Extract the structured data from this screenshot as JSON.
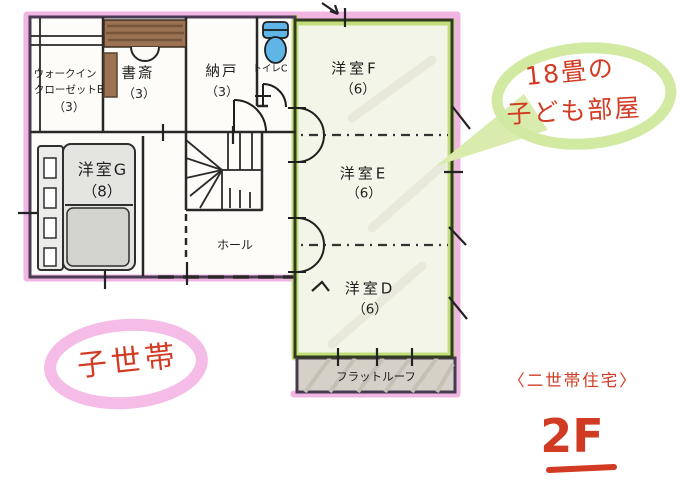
{
  "colors": {
    "highlight_pink": "#efa9dc",
    "highlight_green": "#bedd74",
    "annotation_green": "#d2e9a2",
    "annotation_pink": "#f4bce6",
    "ink_red": "#d23b23",
    "wall_ink": "#2a2a2a",
    "toilet_blue": "#5fb5e6",
    "wood_brown": "#9b7252",
    "roof_gray": "#d5d1c8"
  },
  "rooms": {
    "walk_in_closet_b": {
      "line1": "ウォークイン",
      "line2": "クローゼットB",
      "size": "（3）"
    },
    "study": {
      "name": "書斎",
      "size": "（3）"
    },
    "storage": {
      "name": "納戸",
      "size": "（3）"
    },
    "toilet": {
      "name": "トイレC"
    },
    "room_g": {
      "name": "洋室G",
      "size": "（8）"
    },
    "hall": {
      "name": "ホール"
    },
    "room_f": {
      "name": "洋室F",
      "size": "（6）"
    },
    "room_e": {
      "name": "洋室E",
      "size": "（6）"
    },
    "room_d": {
      "name": "洋室D",
      "size": "（6）"
    },
    "flat_roof": {
      "name": "フラットルーフ"
    }
  },
  "annotations": {
    "children_room_note": {
      "line1": "18畳の",
      "line2": "子ども部屋"
    },
    "household_left": "子世帯",
    "house_type": "〈二世帯住宅〉",
    "floor": "2F"
  }
}
